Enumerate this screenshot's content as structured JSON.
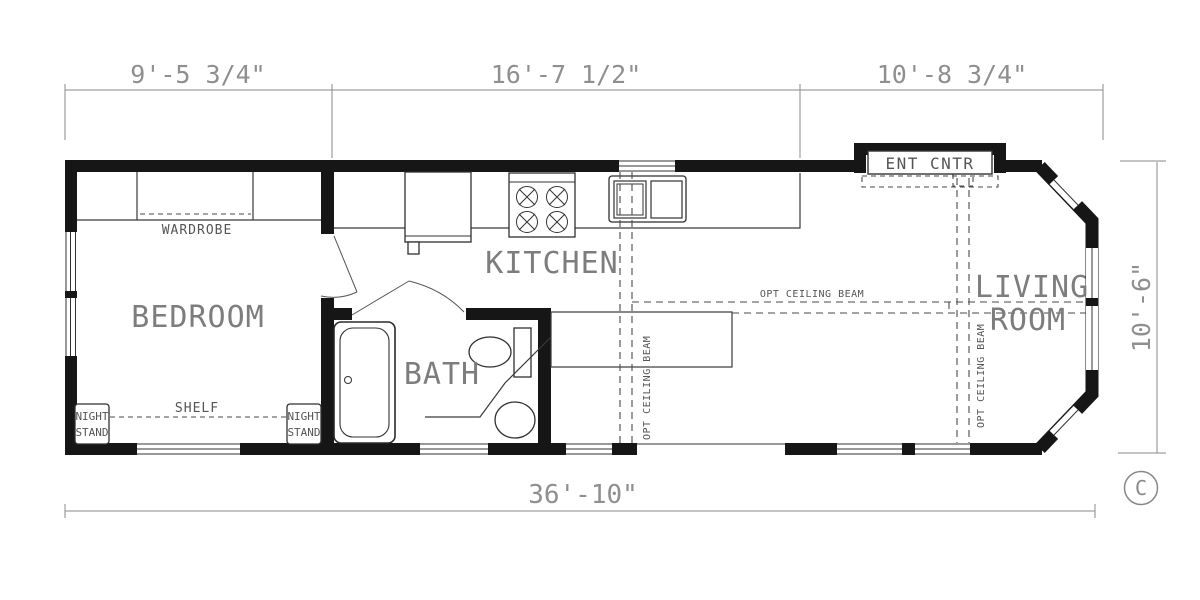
{
  "colors": {
    "wall": "#161616",
    "thin_line": "#3a3a3a",
    "dimension": "#8f8f8f",
    "label": "#555555",
    "room_label": "#7d7d7d",
    "background": "#ffffff"
  },
  "dimensions": {
    "top_left": "9'-5 3/4\"",
    "top_center": "16'-7 1/2\"",
    "top_right": "10'-8 3/4\"",
    "right_side": "10'-6\"",
    "overall_bottom": "36'-10\""
  },
  "rooms": {
    "bedroom": "BEDROOM",
    "kitchen": "KITCHEN",
    "bath": "BATH",
    "living_line1": "LIVING",
    "living_line2": "ROOM"
  },
  "labels": {
    "wardrobe": "WARDROBE",
    "shelf": "SHELF",
    "night_stand_line1": "NIGHT",
    "night_stand_line2": "STAND",
    "ent_cntr": "ENT CNTR",
    "opt_ceiling_beam": "OPT CEILING BEAM",
    "revision_mark": "C"
  }
}
